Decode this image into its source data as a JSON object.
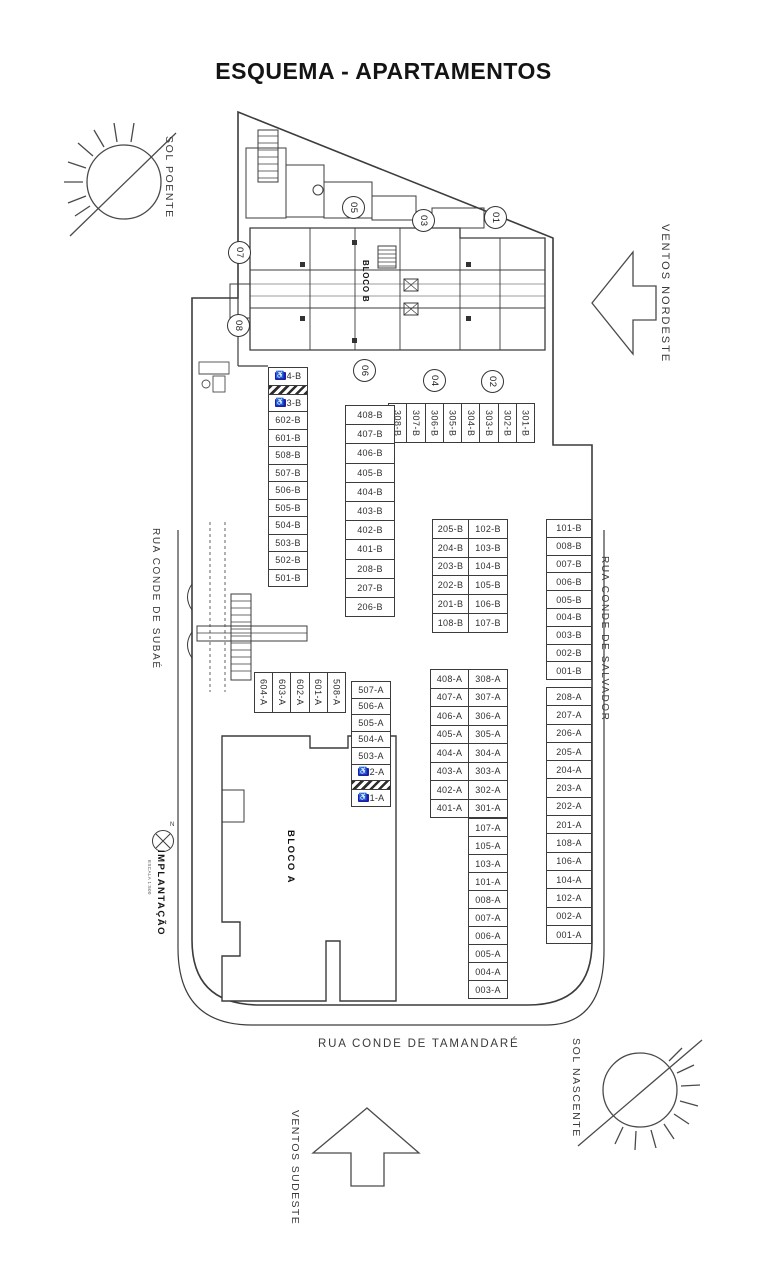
{
  "title": "ESQUEMA - APARTAMENTOS",
  "orientation": {
    "sol_poente": "SOL POENTE",
    "sol_nascente": "SOL NASCENTE",
    "ventos_nordeste": "VENTOS NORDESTE",
    "ventos_sudeste": "VENTOS SUDESTE",
    "north": "N"
  },
  "streets": {
    "left": "RUA CONDE DE SUBAÉ",
    "right": "RUA CONDE DE SALVADOR",
    "bottom": "RUA CONDE DE TAMANDARÉ"
  },
  "buildings": {
    "bloco_a": "BLOCO A",
    "bloco_b": "BLOCO B"
  },
  "caption": {
    "title": "IMPLANTAÇÃO",
    "scale": "ESCALA 1:500"
  },
  "unit_markers": {
    "m01": "01",
    "m02": "02",
    "m03": "03",
    "m04": "04",
    "m05": "05",
    "m06": "06",
    "m07": "07",
    "m08": "08"
  },
  "icons": {
    "accessible": "♿"
  },
  "colors": {
    "line": "#3c3c3c",
    "accessible_badge": "#1c1cb0"
  },
  "parking": {
    "b_top_row": [
      "308-B",
      "307-B",
      "306-B",
      "305-B",
      "304-B",
      "303-B",
      "302-B",
      "301-B"
    ],
    "b_col_left": [
      {
        "label": "4-B",
        "accessible": true
      },
      {
        "hatch": true
      },
      {
        "label": "3-B",
        "accessible": true
      },
      "602-B",
      "601-B",
      "508-B",
      "507-B",
      "506-B",
      "505-B",
      "504-B",
      "503-B",
      "502-B",
      "501-B"
    ],
    "b_col_2": [
      "408-B",
      "407-B",
      "406-B",
      "405-B",
      "404-B",
      "403-B",
      "402-B",
      "401-B",
      "208-B",
      "207-B",
      "206-B"
    ],
    "b_col_3_left": [
      "205-B",
      "204-B",
      "203-B",
      "202-B",
      "201-B",
      "108-B"
    ],
    "b_col_3_right": [
      "102-B",
      "103-B",
      "104-B",
      "105-B",
      "106-B",
      "107-B"
    ],
    "b_col_right": [
      "101-B",
      "008-B",
      "007-B",
      "006-B",
      "005-B",
      "004-B",
      "003-B",
      "002-B",
      "001-B"
    ],
    "a_col_right": [
      "208-A",
      "207-A",
      "206-A",
      "205-A",
      "204-A",
      "203-A",
      "202-A",
      "201-A",
      "108-A",
      "106-A",
      "104-A",
      "102-A",
      "002-A",
      "001-A"
    ],
    "a_top_row": [
      "604-A",
      "603-A",
      "602-A",
      "601-A",
      "508-A"
    ],
    "a_col_left": [
      "507-A",
      "506-A",
      "505-A",
      "504-A",
      "503-A",
      {
        "label": "2-A",
        "accessible": true
      },
      {
        "hatch": true
      },
      {
        "label": "1-A",
        "accessible": true
      }
    ],
    "a_col_2_left": [
      "408-A",
      "407-A",
      "406-A",
      "405-A",
      "404-A",
      "403-A",
      "402-A",
      "401-A"
    ],
    "a_col_2_right": [
      "308-A",
      "307-A",
      "306-A",
      "305-A",
      "304-A",
      "303-A",
      "302-A",
      "301-A"
    ],
    "a_col_3": [
      "107-A",
      "105-A",
      "103-A",
      "101-A",
      "008-A",
      "007-A",
      "006-A",
      "005-A",
      "004-A",
      "003-A"
    ]
  }
}
